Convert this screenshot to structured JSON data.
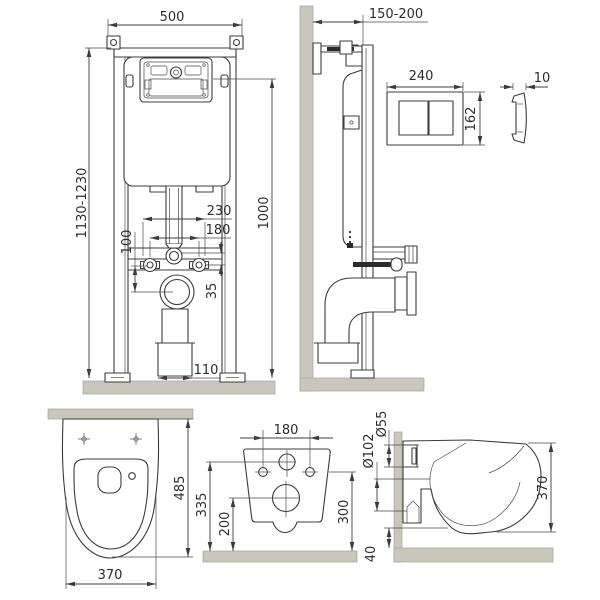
{
  "drawing": {
    "type": "wall-hung toilet installation frame technical drawing",
    "colors": {
      "line": "#3c3c3c",
      "wall_fill": "#c9c6bc",
      "text": "#2d2d2d",
      "background": "#ffffff"
    },
    "frame_front": {
      "width": "500",
      "height_adjustable": "1130-1230",
      "frame_height": "1000",
      "anchor_outer_width": "230",
      "anchor_spacing": "180",
      "anchor_to_drain": "100",
      "inlet_to_anchor": "35",
      "drain_width": "110"
    },
    "frame_side": {
      "depth_adjustable": "150-200"
    },
    "flush_plate": {
      "width": "240",
      "height": "162",
      "thickness": "10"
    },
    "bowl_top": {
      "depth": "485",
      "width": "370"
    },
    "bowl_rear": {
      "bolt_spacing": "180",
      "inlet_height": "335",
      "outlet_height": "200",
      "bolt_height": "300"
    },
    "bowl_side": {
      "inlet_diameter": "Ø55",
      "outlet_diameter": "Ø102",
      "height": "370",
      "gap_under_rim": "40"
    }
  }
}
